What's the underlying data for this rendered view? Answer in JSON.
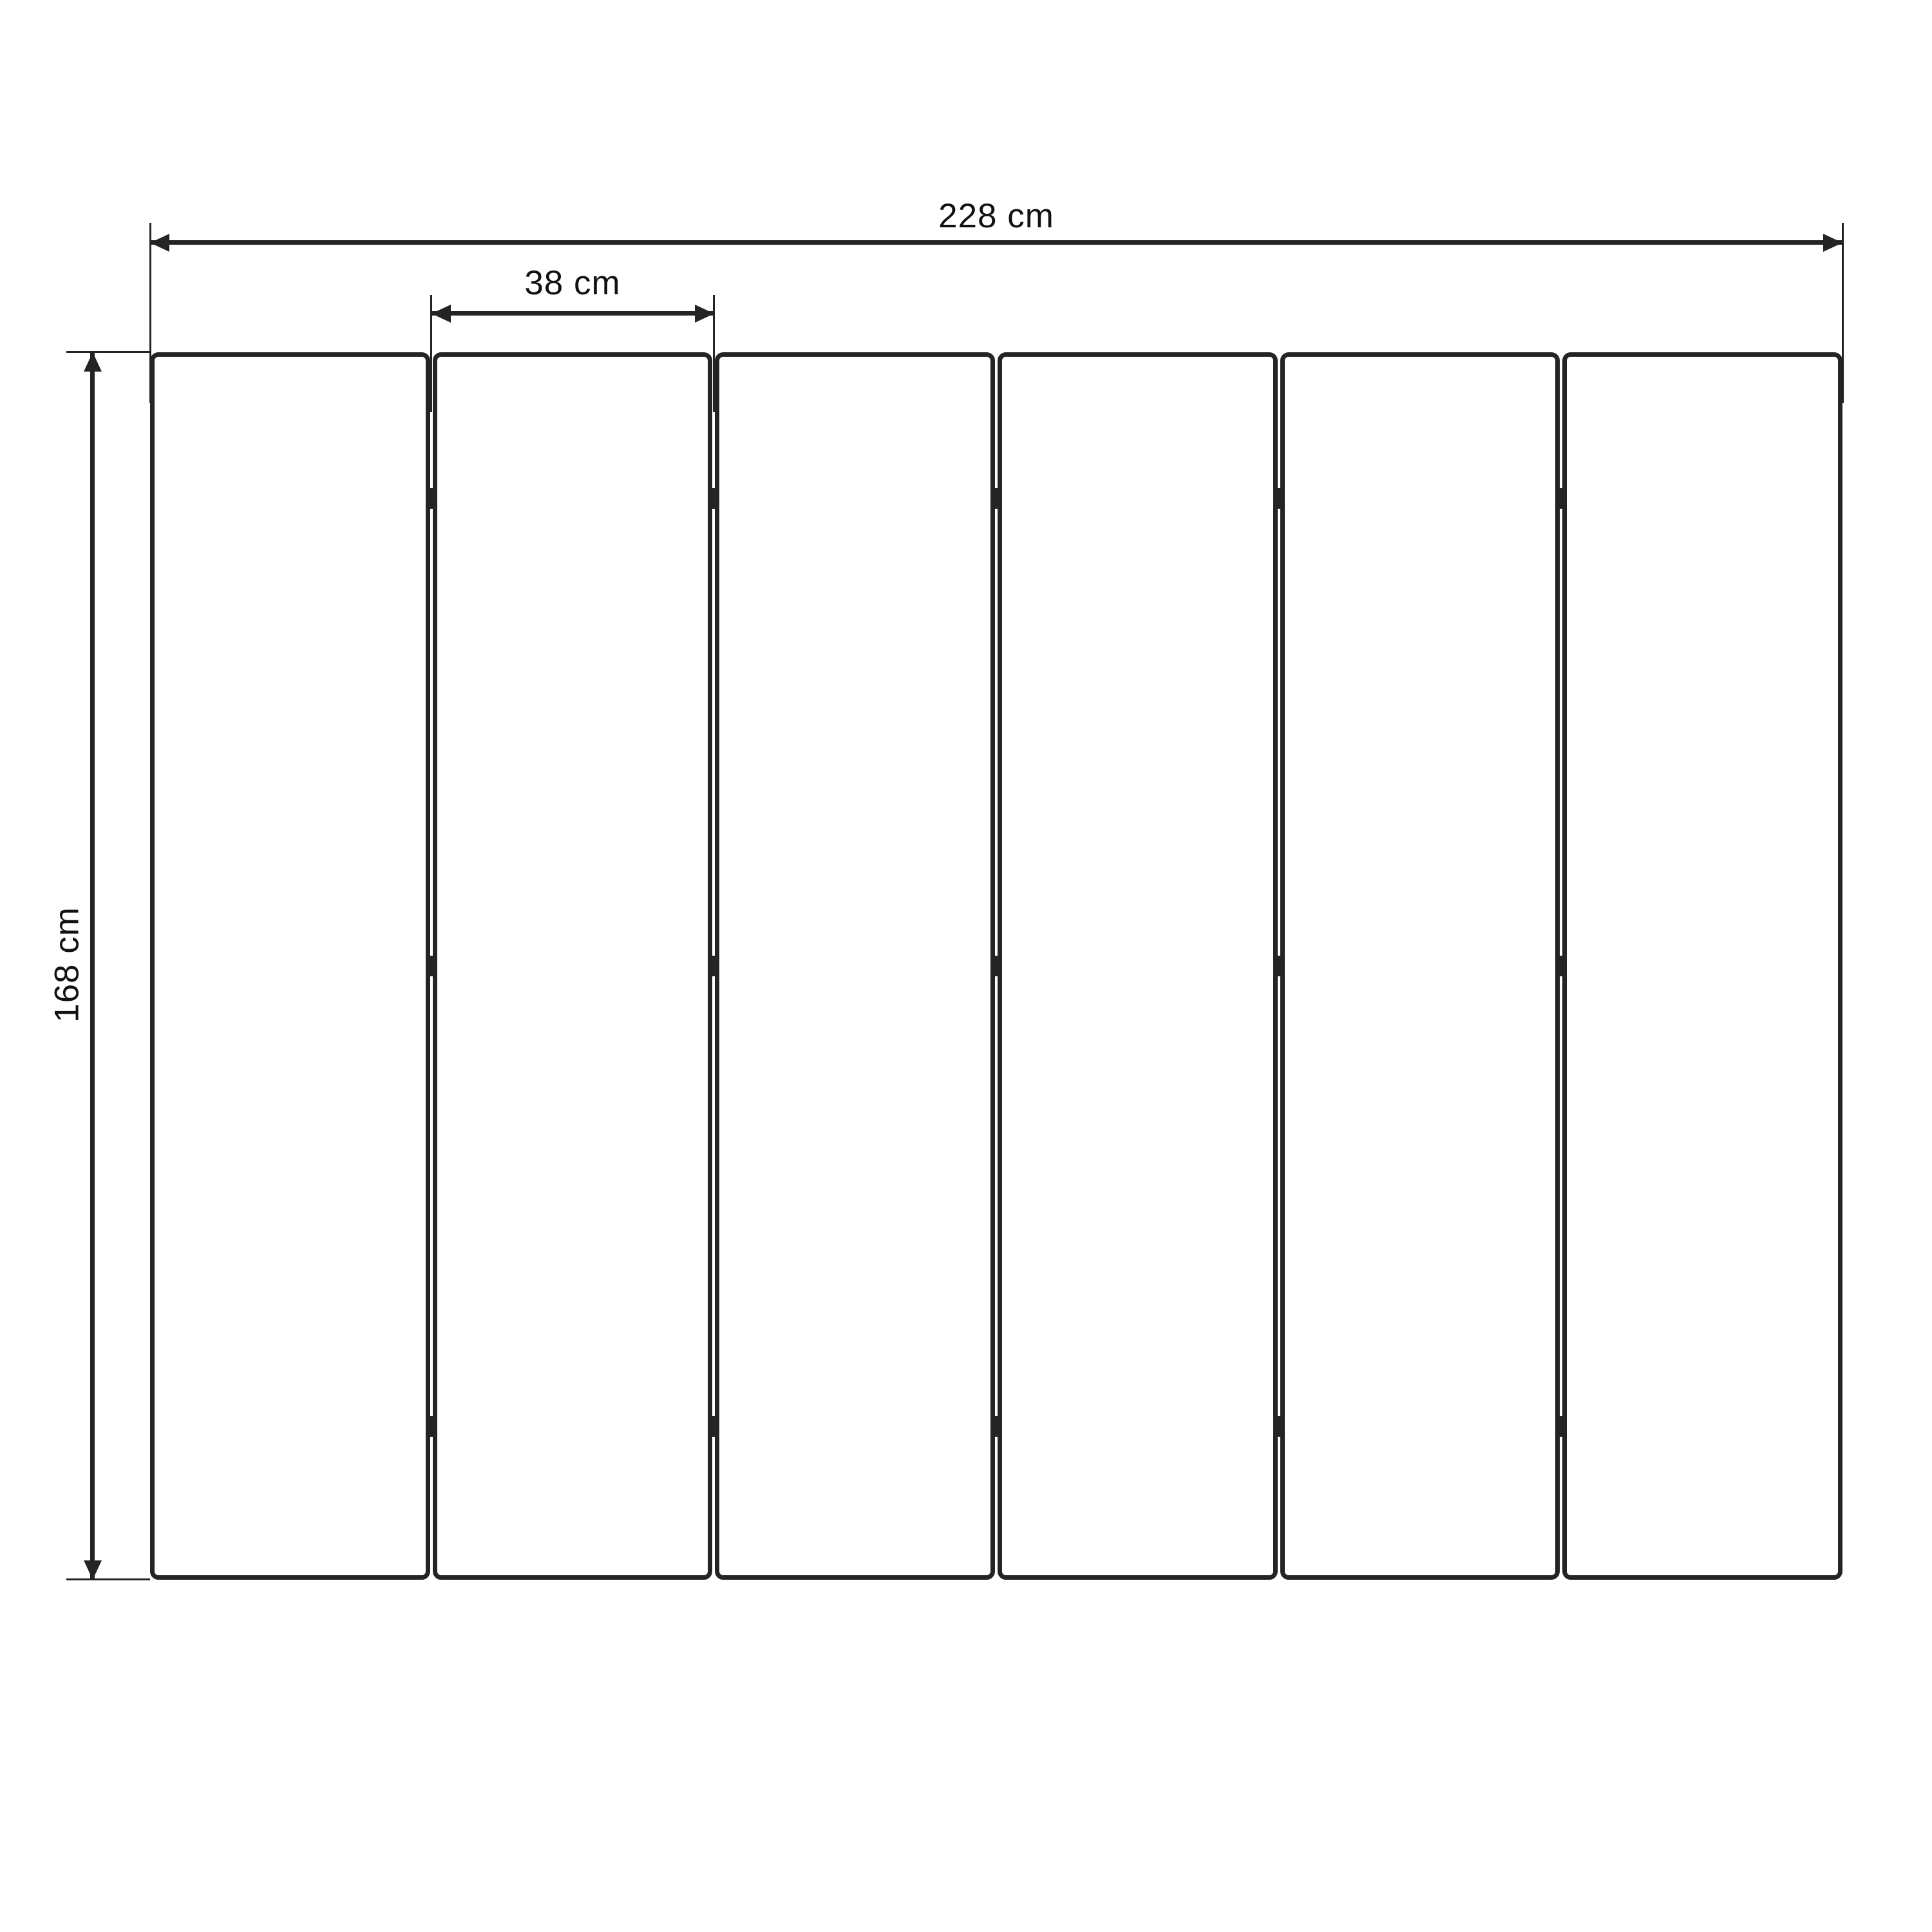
{
  "diagram": {
    "labels": {
      "total_width": "228 cm",
      "panel_width": "38 cm",
      "height": "168 cm"
    },
    "panel_count": 6,
    "gap_count": 5,
    "hinge_rows_per_gap": 3,
    "colors": {
      "line": "#242424",
      "text": "#111111",
      "background": "#ffffff"
    }
  }
}
